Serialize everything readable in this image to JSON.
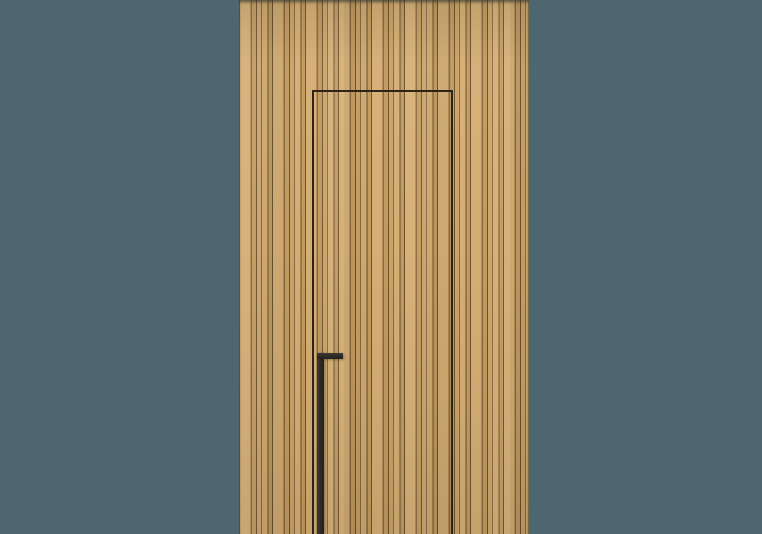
{
  "scene": {
    "description": "Studio product photograph of a concealed flush interior door clad in vertical oak wood slats, seamlessly integrated into a matching slatted wall panel, set against a muted teal backdrop",
    "backdrop": "plain muted teal studio background",
    "wall": "full-height vertical oak slat panel with alternating wide boards and narrow battens",
    "door": "frameless hidden door revealed only by a thin dark shadow gap on its top, left and right edges; bottom edge cropped out of frame",
    "handle": "long matte black vertical pull handle with a short horizontal arm at its top, mounted near the door's left edge, running off the bottom of the frame"
  },
  "colors": {
    "backdrop": "#4d6670",
    "wood_light": "#d5ae74",
    "wood_medium": "#cba268",
    "wood_slat": "#c29a5e",
    "wood_groove_mid": "#8a6a3e",
    "wood_groove_dark": "#6b522c",
    "door_outline": "#2d2318",
    "handle_dark": "#262522",
    "handle_light": "#3c3a36"
  }
}
